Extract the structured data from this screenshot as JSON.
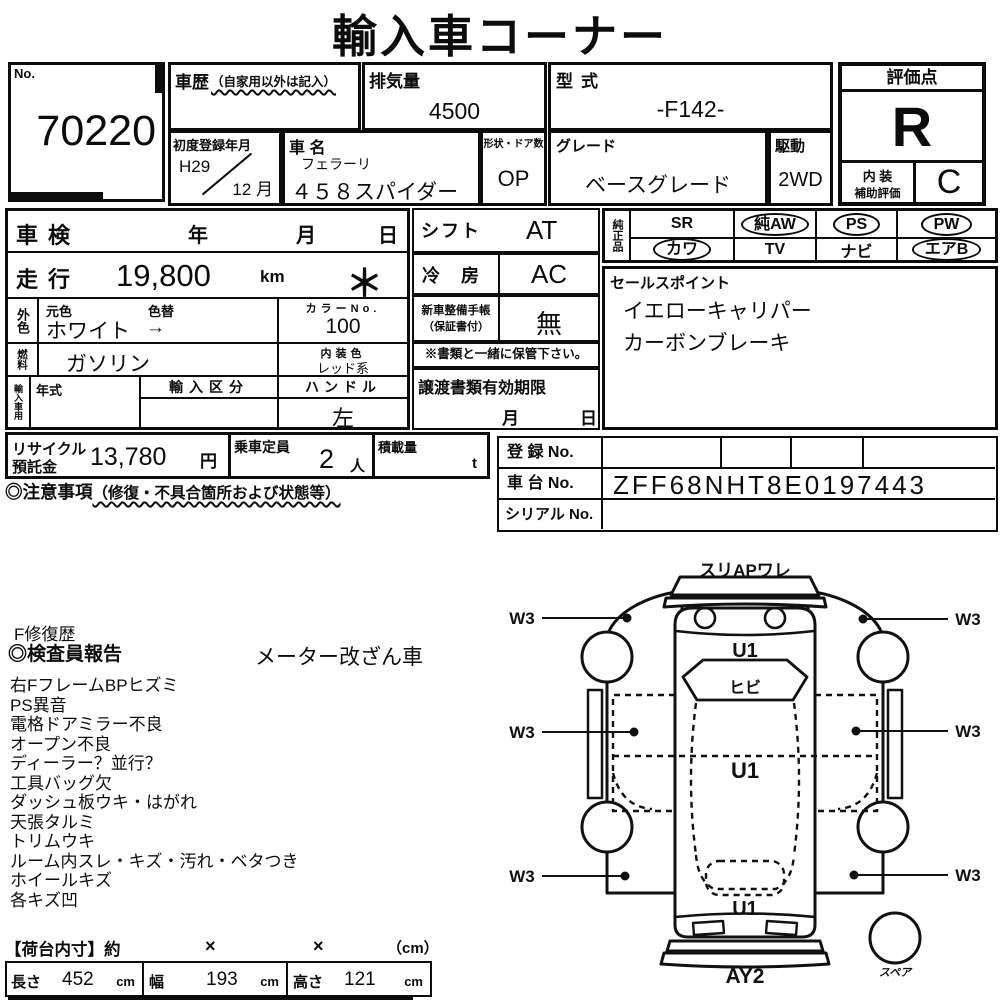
{
  "title": "輸入車コーナー",
  "no_box": {
    "label": "No.",
    "value": "70220"
  },
  "history": {
    "label": "車歴",
    "note": "（自家用以外は記入）"
  },
  "displacement": {
    "label": "排気量",
    "value": "4500"
  },
  "model_code": {
    "label": "型式",
    "value": "-F142-"
  },
  "first_reg": {
    "label": "初度登録年月",
    "year": "H29",
    "month": "12 月"
  },
  "car_name": {
    "label": "車 名",
    "make": "フェラーリ",
    "model": "４５８スパイダー"
  },
  "shape_doors": {
    "label": "形状・ドア数",
    "value": "OP"
  },
  "grade": {
    "label": "グレード",
    "value": "ベースグレード"
  },
  "drive": {
    "label": "駆動",
    "value": "2WD"
  },
  "score": {
    "label": "評価点",
    "value": "R",
    "interior_label_line1": "内 装",
    "interior_label_line2": "補助評価",
    "interior_value": "C"
  },
  "inspection": {
    "label": "車検",
    "year": "年",
    "month": "月",
    "day": "日"
  },
  "mileage": {
    "label": "走行",
    "value": "19,800",
    "unit": "km",
    "mark": "＊"
  },
  "exterior_color": {
    "label": "外色",
    "original_label": "元色",
    "change_label": "色替",
    "value": "ホワイト",
    "arrow": "→",
    "color_no_label": "カラーNo.",
    "color_no": "100"
  },
  "fuel": {
    "label": "燃料",
    "value": "ガソリン",
    "interior_color_label": "内装色",
    "interior_color": "レッド系"
  },
  "import_info": {
    "label": "輸入車用",
    "year_label": "年式",
    "division_label": "輸入区分",
    "handle_label": "ハンドル",
    "handle_value": "左"
  },
  "shift": {
    "label": "シフト",
    "value": "AT"
  },
  "aircon": {
    "label": "冷 房",
    "value": "AC"
  },
  "service_book": {
    "label_line1": "新車整備手帳",
    "label_line2": "（保証書付）",
    "value": "無"
  },
  "keep_note": "※書類と一緒に保管下さい。",
  "transfer_docs": {
    "label": "譲渡書類有効期限",
    "month": "月",
    "day": "日"
  },
  "genuine_parts": {
    "label": "純正品",
    "row1": [
      {
        "text": "SR",
        "circled": false
      },
      {
        "text": "純AW",
        "circled": true
      },
      {
        "text": "PS",
        "circled": true
      },
      {
        "text": "PW",
        "circled": true
      }
    ],
    "row2": [
      {
        "text": "カワ",
        "circled": true
      },
      {
        "text": "TV",
        "circled": false
      },
      {
        "text": "ナビ",
        "circled": false
      },
      {
        "text": "エアB",
        "circled": true
      }
    ]
  },
  "sales_points": {
    "label": "セールスポイント",
    "lines": [
      "イエローキャリパー",
      "カーボンブレーキ"
    ]
  },
  "recycle_deposit": {
    "label_line1": "リサイクル",
    "label_line2": "預託金",
    "value": "13,780",
    "unit": "円"
  },
  "seating": {
    "label": "乗車定員",
    "value": "2",
    "unit": "人"
  },
  "load_capacity": {
    "label": "積載量",
    "unit": "t"
  },
  "caution": {
    "label": "◎注意事項",
    "note": "（修復・不具合箇所および状態等）"
  },
  "registration": {
    "reg_label": "登 録 No.",
    "chassis_label": "車 台 No.",
    "chassis_value": "ZFF68NHT8E0197443",
    "serial_label": "シリアル No."
  },
  "inspector_report": {
    "repair_history": "F修復歴",
    "report_title": "◎検査員報告",
    "meter_note": "メーター改ざん車",
    "findings": [
      "右FフレームBPヒズミ",
      "PS異音",
      "電格ドアミラー不良",
      "オープン不良",
      "ディーラー？並行？",
      "工具バッグ欠",
      "ダッシュ板ウキ・はがれ",
      "天張タルミ",
      "トリムウキ",
      "ルーム内スレ・キズ・汚れ・ベタつき",
      "ホイールキズ",
      "各キズ凹"
    ]
  },
  "diagram": {
    "front_note": "スリAPワレ",
    "hood_mark": "U1",
    "windshield_mark": "ヒビ",
    "cabin_mark": "U1",
    "rear_mark": "U1",
    "bumper_mark": "AY2",
    "spare_label": "スペア",
    "side_mark": "W3"
  },
  "cargo_dimensions": {
    "header_label": "【荷台内寸】約",
    "x1": "×",
    "x2": "×",
    "unit_note": "（cm）",
    "length": {
      "label": "長さ",
      "value": "452",
      "unit": "cm"
    },
    "width": {
      "label": "幅",
      "value": "193",
      "unit": "cm"
    },
    "height": {
      "label": "高さ",
      "value": "121",
      "unit": "cm"
    }
  }
}
